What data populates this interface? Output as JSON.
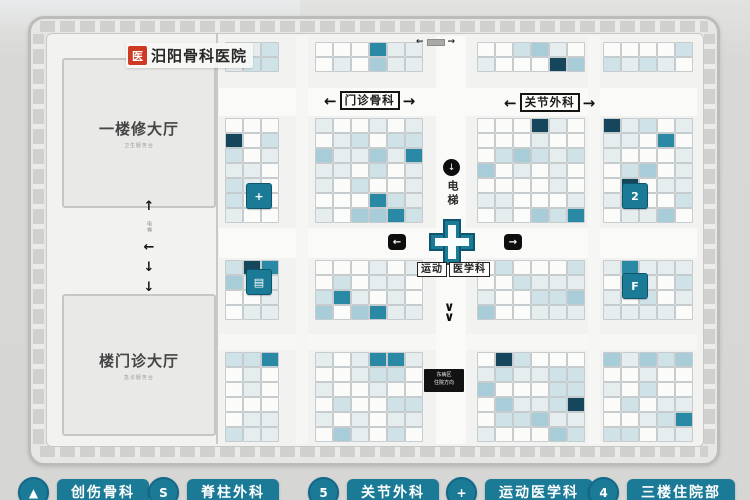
{
  "colors": {
    "page_bg": "#d8d8d6",
    "accent_teal": "#1b7b96",
    "accent_teal_dark": "#0d566e",
    "logo_red": "#cf3a24",
    "cell_border": "#c6cccd",
    "cell_colors": [
      "#fbfbfa",
      "#e6edef",
      "#cfe2e8",
      "#a9cdd8",
      "#2a8aa5",
      "#15465c"
    ]
  },
  "logo": {
    "icon_glyph": "医",
    "text": "汨阳骨科医院"
  },
  "halls": {
    "upper": {
      "title": "一楼修大厅",
      "subtitle": "卫生服务台"
    },
    "lower": {
      "title": "楼门诊大厅",
      "subtitle": "急诊服务台"
    }
  },
  "corridor_signs": {
    "left": {
      "arrow_left": "←",
      "label": "门诊骨科",
      "arrow_right": "→"
    },
    "right": {
      "arrow_left": "←",
      "label": "关节外科",
      "arrow_right": "→"
    }
  },
  "center_cross": {
    "dept_left": "运动",
    "dept_right": "医学科"
  },
  "markers": {
    "left_badge_arrow": "←",
    "right_badge_arrow": "→",
    "elevator_icon": "↓",
    "elevator_text": "电梯",
    "down_chevrons": [
      "∨",
      "∨"
    ],
    "nav_column": {
      "up": "↑",
      "small_text": "电梯",
      "left": "←",
      "down1": "↓",
      "down2": "↓"
    },
    "north_indicator": {
      "left": "←",
      "right": "→"
    }
  },
  "sign_box": {
    "line1": "东病区",
    "line2": "住院方向"
  },
  "dept_badges": [
    {
      "glyph": "+"
    },
    {
      "glyph": "▤"
    },
    {
      "glyph": "2"
    },
    {
      "glyph": "F"
    }
  ],
  "legend": [
    {
      "icon": "▲",
      "label": "创伤骨科"
    },
    {
      "icon": "S",
      "label": "脊柱外科"
    },
    {
      "icon": "5",
      "label": "关节外科"
    },
    {
      "icon": "+",
      "label": "运动医学科"
    },
    {
      "icon": "4",
      "label": "三楼住院部"
    }
  ]
}
